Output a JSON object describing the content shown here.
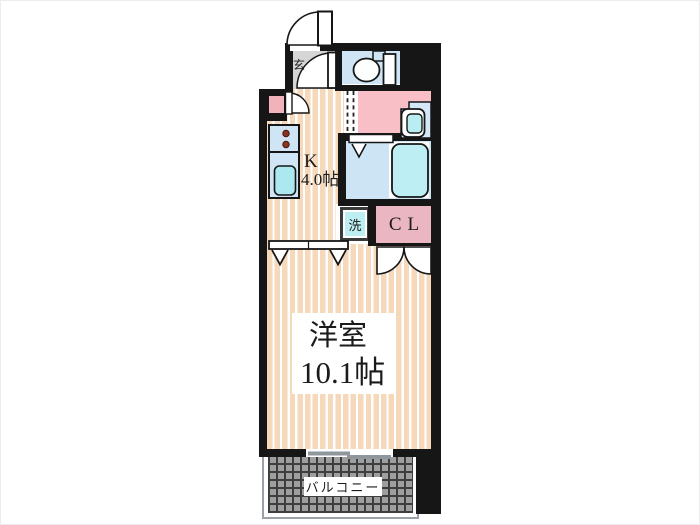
{
  "floorplan": {
    "entrance": {
      "label": "玄"
    },
    "kitchen": {
      "name": "K",
      "size": "4.0帖"
    },
    "laundry": {
      "label": "洗"
    },
    "closet": {
      "label": "CL"
    },
    "western_room": {
      "name": "洋室",
      "size": "10.1帖"
    },
    "balcony": {
      "label": "バルコニー"
    },
    "colors": {
      "wall": "#161616",
      "flooring_stripe": "#f6d8ba",
      "entrance_gray": "#d5d5d5",
      "wet_area_blue": "#cfe4f5",
      "fixture_cyan": "#ace9ee",
      "bathtub_cyan": "#bceef3",
      "washroom_pink": "#f8bfc6",
      "closet_pink": "#eab6c2",
      "laundry_cyan": "#bdeef2",
      "balcony_gray": "#9e9e9e",
      "window_gray": "#8f969c"
    }
  }
}
